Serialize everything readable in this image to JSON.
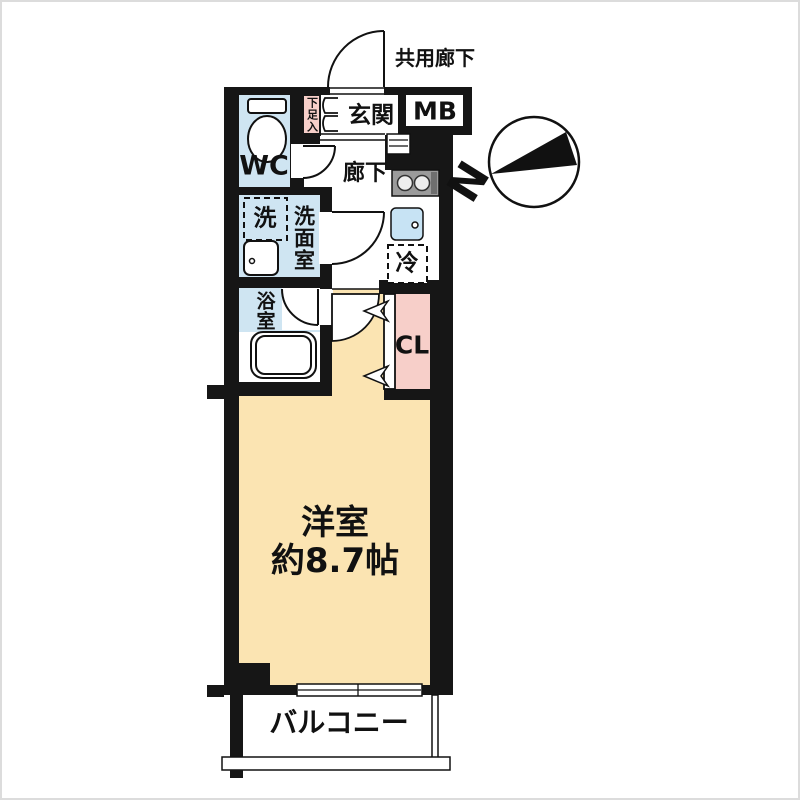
{
  "plan_title": "1K apartment floor plan",
  "labels": {
    "shared_corridor": "共用廊下",
    "entrance": "玄関",
    "meter_box": "MB",
    "shoe_cabinet": "下足入",
    "toilet_room": "WC",
    "hallway": "廊下",
    "washer": "洗",
    "washroom": "洗面室",
    "refrigerator": "冷",
    "bathroom": "浴室",
    "closet": "CL",
    "room_type": "洋室",
    "room_size": "約8.7帖",
    "balcony": "バルコニー",
    "north": "N"
  },
  "colors": {
    "wall": "#161616",
    "water_blue": "#cfe5f2",
    "sink_blue": "#c7e3f4",
    "accent_pink": "#f7cfc9",
    "room_cream": "#fbe4b2",
    "stove_gray": "#9b9b9b",
    "stove_grill": "#6f6f6f",
    "line": "#111111"
  }
}
